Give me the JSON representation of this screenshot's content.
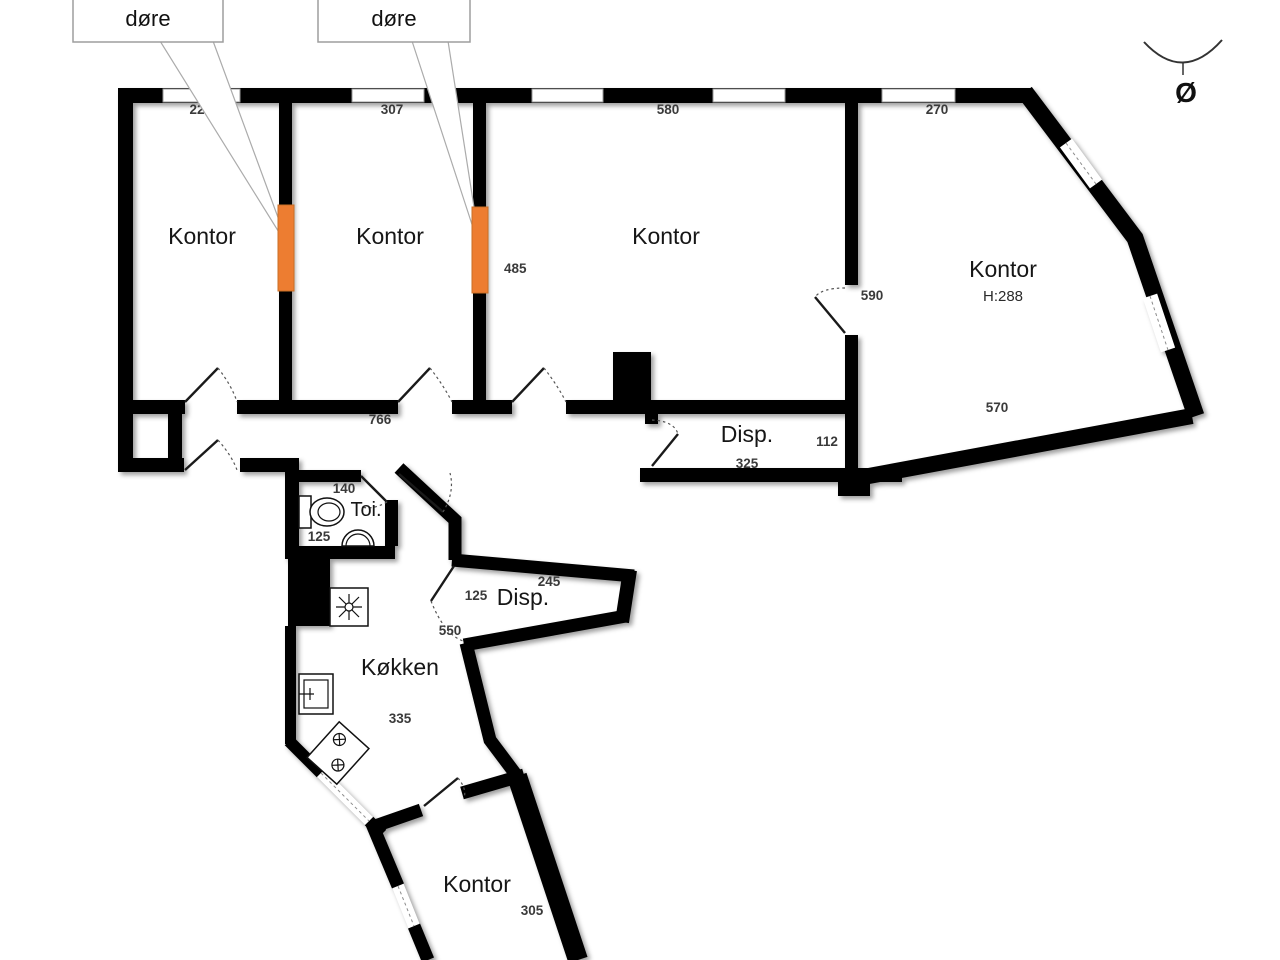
{
  "callouts": {
    "left": "døre",
    "right": "døre"
  },
  "compass": {
    "direction": "Ø"
  },
  "rooms": {
    "kontor1": "Kontor",
    "kontor2": "Kontor",
    "kontor3": "Kontor",
    "kontor4": "Kontor",
    "kontor4_height": "H:288",
    "disp1": "Disp.",
    "toi": "Toi.",
    "disp2": "Disp.",
    "kokken": "Køkken",
    "kontor5": "Kontor"
  },
  "dimensions": {
    "kontor1_top": "22",
    "kontor2_top": "307",
    "kontor3_top": "580",
    "kontor4_top": "270",
    "door2_height": "485",
    "kontor4_door": "590",
    "kontor4_width": "570",
    "hallway_length": "766",
    "disp1_depth": "112",
    "disp1_length": "325",
    "toi_top": "140",
    "toi_bottom": "125",
    "disp2_top": "245",
    "disp2_left": "125",
    "disp2_outside": "550",
    "kokken_width": "335",
    "kontor5_width": "305"
  },
  "colors": {
    "wall": "#000000",
    "door_marker": "#ED7D31",
    "background": "#ffffff"
  }
}
